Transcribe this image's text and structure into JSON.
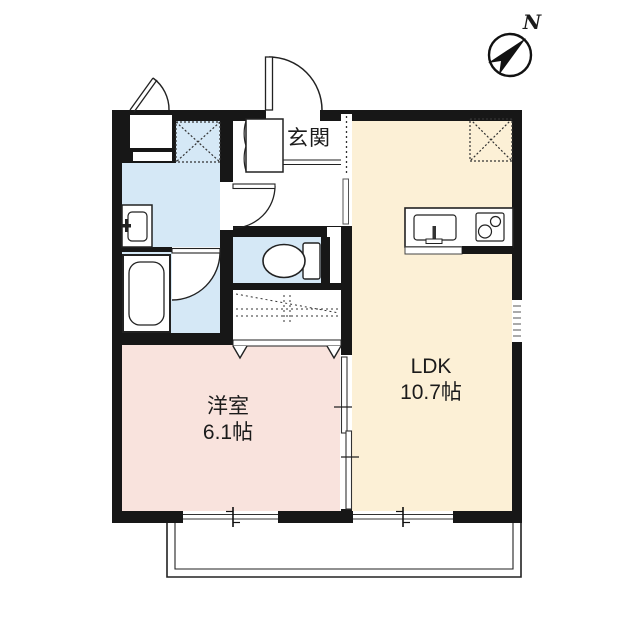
{
  "floor_plan": {
    "labels": {
      "genkan": "玄関",
      "ldk_name": "LDK",
      "ldk_size": "10.7帖",
      "western_room_name": "洋室",
      "western_room_size": "6.1帖",
      "compass_north": "N"
    },
    "rooms": [
      {
        "name": "entrance-hall",
        "label": "玄関"
      },
      {
        "name": "ldk",
        "label": "LDK",
        "area": "10.7帖"
      },
      {
        "name": "western-room",
        "label": "洋室",
        "area": "6.1帖"
      },
      {
        "name": "washroom"
      },
      {
        "name": "bathroom"
      },
      {
        "name": "toilet-room"
      },
      {
        "name": "closet"
      },
      {
        "name": "balcony"
      }
    ],
    "fixtures": [
      "north-compass-icon",
      "entrance-swing-door",
      "shoe-cabinet",
      "washing-machine-space",
      "refrigerator-space",
      "washbasin",
      "bathtub",
      "toilet-bowl",
      "kitchen-sink",
      "gas-stove-2-burner",
      "closet-folding-doors",
      "sliding-door-west-ldk",
      "sliding-windows",
      "louver-window",
      "outdoor-storage-door"
    ],
    "colors": {
      "wall": "#171717",
      "ldk_fill": "#fcf0d6",
      "western_room_fill": "#f9e3dd",
      "wet_area_fill": "#d5e8f6",
      "background": "#ffffff",
      "line": "#222222"
    }
  }
}
